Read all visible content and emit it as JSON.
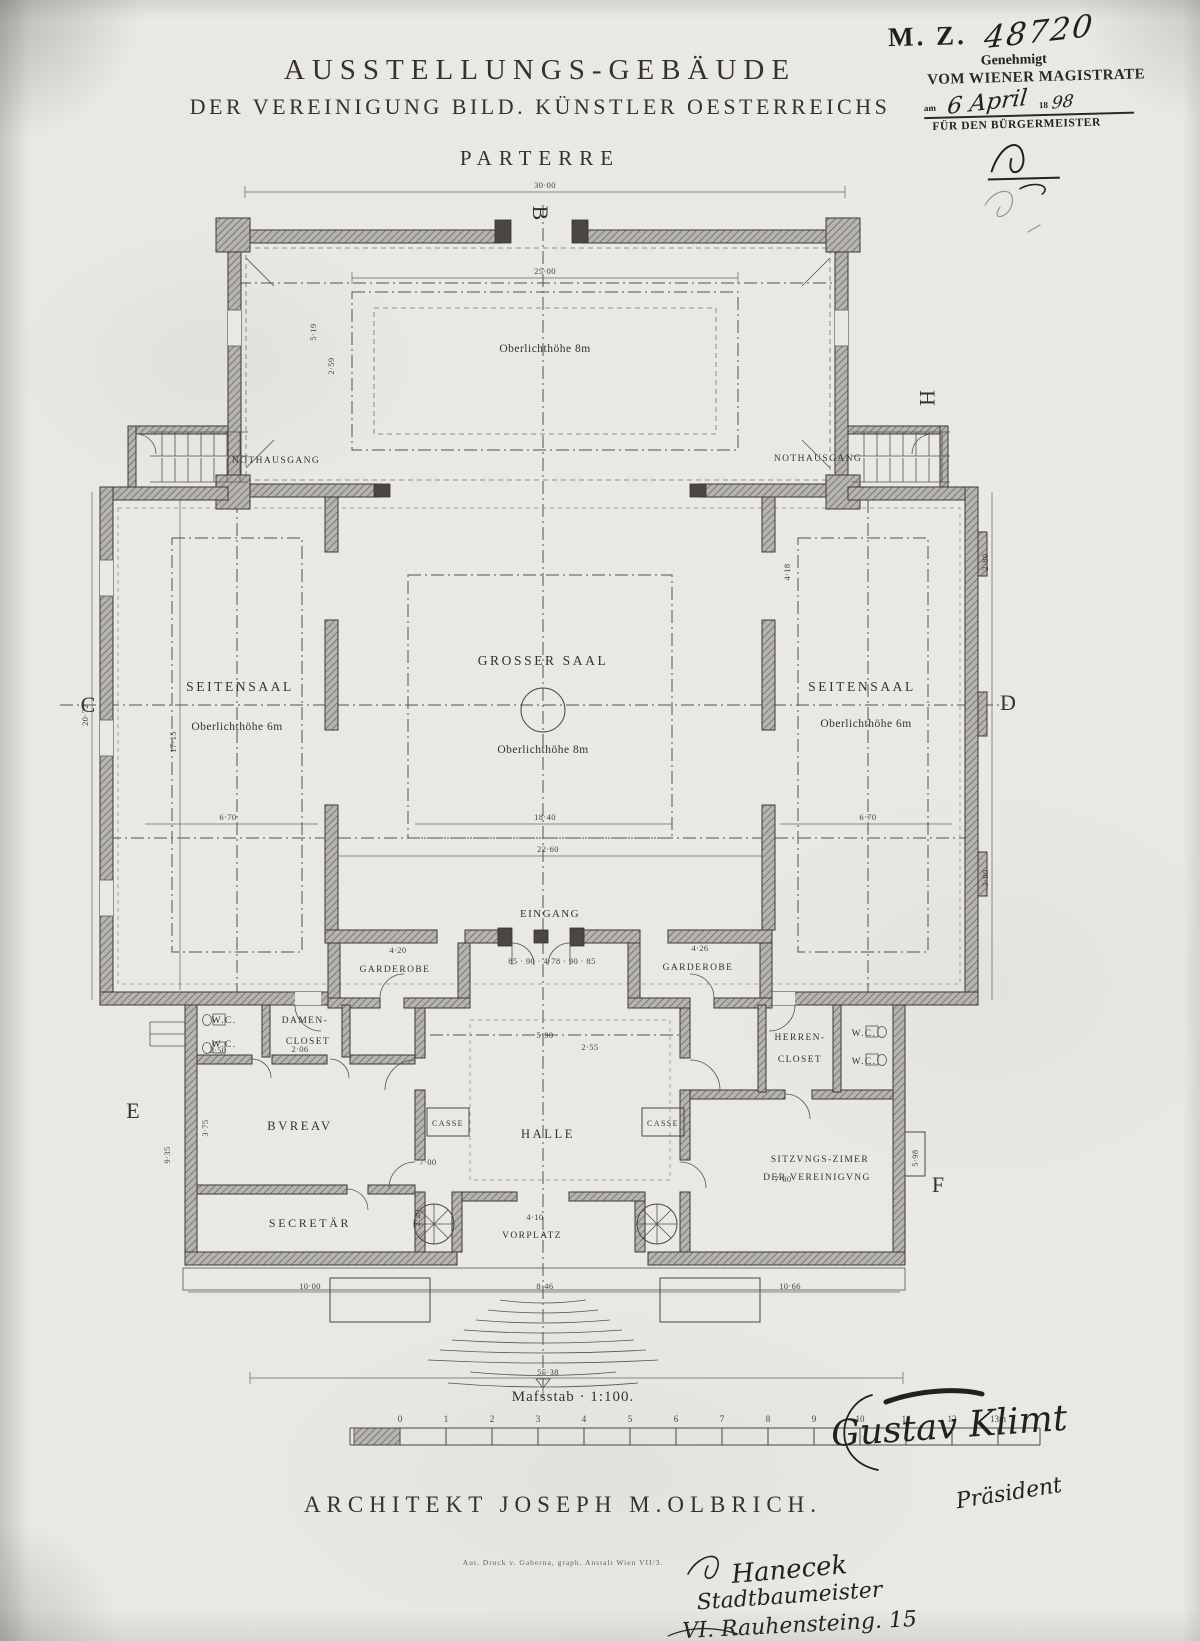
{
  "title": {
    "line1": "AUSSTELLUNGS-GEBÄUDE",
    "line2": "DER VEREINIGUNG BILD. KÜNSTLER OESTERREICHS",
    "floor": "PARTERRE"
  },
  "stamp": {
    "code": "M. Z.",
    "number": "48720",
    "approved": "Genehmigt",
    "authority": "VOM WIENER MAGISTRATE",
    "date_prefix": "am",
    "date_hand": "6 April",
    "year_print": "18",
    "year_hand": "98",
    "for_mayor": "FÜR DEN BÜRGERMEISTER"
  },
  "plan": {
    "labels": {
      "skylight_8m": "Oberlichthöhe 8m",
      "nothausgang": "NOTHAUSGANG",
      "seitensaal": "SEITENSAAL",
      "oberlicht_6m": "Oberlichthöhe 6m",
      "grosser_saal": "GROSSER SAAL",
      "oberlicht_8m": "Oberlichthöhe 8m",
      "eingang": "EINGANG",
      "garderobe": "GARDEROBE",
      "wc": "W.C.",
      "damen_line1": "DAMEN-",
      "damen_line2": "CLOSET",
      "herren_line1": "HERREN-",
      "herren_line2": "CLOSET",
      "bureau": "BVREAV",
      "secretaer": "SECRETÄR",
      "casse": "CASSE",
      "halle": "HALLE",
      "sitzung_line1": "SITZVNGS-ZIMER",
      "sitzung_line2": "DER VEREINIGVNG",
      "vorplatz": "VORPLATZ"
    },
    "markers": {
      "b": "B",
      "c": "C",
      "d": "D",
      "e": "E",
      "f": "F",
      "h": "H"
    },
    "dimensions": [
      {
        "x": 545,
        "y": 188,
        "t": "30·00"
      },
      {
        "x": 545,
        "y": 274,
        "t": "25·00"
      },
      {
        "x": 316,
        "y": 332,
        "t": "5·19",
        "r": -90
      },
      {
        "x": 334,
        "y": 366,
        "t": "2·59",
        "r": -90
      },
      {
        "x": 88,
        "y": 715,
        "t": "20·72",
        "r": -90
      },
      {
        "x": 176,
        "y": 742,
        "t": "17·15",
        "r": -90
      },
      {
        "x": 545,
        "y": 820,
        "t": "18·40"
      },
      {
        "x": 228,
        "y": 820,
        "t": "6·70"
      },
      {
        "x": 868,
        "y": 820,
        "t": "6·70"
      },
      {
        "x": 548,
        "y": 852,
        "t": "22·60"
      },
      {
        "x": 988,
        "y": 562,
        "t": "2·80",
        "r": -90
      },
      {
        "x": 988,
        "y": 878,
        "t": "3·80",
        "r": -90
      },
      {
        "x": 790,
        "y": 572,
        "t": "4·18",
        "r": -90
      },
      {
        "x": 398,
        "y": 953,
        "t": "4·20"
      },
      {
        "x": 700,
        "y": 951,
        "t": "4·26"
      },
      {
        "x": 552,
        "y": 964,
        "t": "85 · 90 · 4·78 · 90 · 85"
      },
      {
        "x": 545,
        "y": 1038,
        "t": "5·90"
      },
      {
        "x": 300,
        "y": 1052,
        "t": "2·06"
      },
      {
        "x": 590,
        "y": 1050,
        "t": "2·55"
      },
      {
        "x": 218,
        "y": 1053,
        "t": "2·50"
      },
      {
        "x": 208,
        "y": 1128,
        "t": "3·75",
        "r": -90
      },
      {
        "x": 170,
        "y": 1155,
        "t": "9·35",
        "r": -90
      },
      {
        "x": 428,
        "y": 1165,
        "t": "7·00"
      },
      {
        "x": 783,
        "y": 1182,
        "t": "7·00"
      },
      {
        "x": 420,
        "y": 1218,
        "t": "2·20",
        "r": -90
      },
      {
        "x": 918,
        "y": 1158,
        "t": "5·98",
        "r": -90
      },
      {
        "x": 535,
        "y": 1220,
        "t": "4·10"
      },
      {
        "x": 310,
        "y": 1289,
        "t": "10·00"
      },
      {
        "x": 545,
        "y": 1289,
        "t": "8·46"
      },
      {
        "x": 790,
        "y": 1289,
        "t": "10·66"
      },
      {
        "x": 548,
        "y": 1375,
        "t": "55·38"
      }
    ]
  },
  "scale": {
    "label": "Mafsstab · 1:100.",
    "ticks": [
      "0",
      "1",
      "2",
      "3",
      "4",
      "5",
      "6",
      "7",
      "8",
      "9",
      "10",
      "11",
      "12",
      "13m"
    ]
  },
  "footer": {
    "architect": "ARCHITEKT JOSEPH M.OLBRICH.",
    "printer": "Aut. Druck v. Gaberna, graph. Anstalt Wien VII/3."
  },
  "signatures": {
    "artist": "Gustav Klimt",
    "artist_title": "Präsident",
    "builder": "Hanecek",
    "builder_title": "Stadtbaumeister",
    "builder_address": "VI. Rauhensteing. 15"
  },
  "colors": {
    "paper": "#e9e8e4",
    "ink": "#35322d",
    "wall_fill": "#b7b5b0"
  }
}
